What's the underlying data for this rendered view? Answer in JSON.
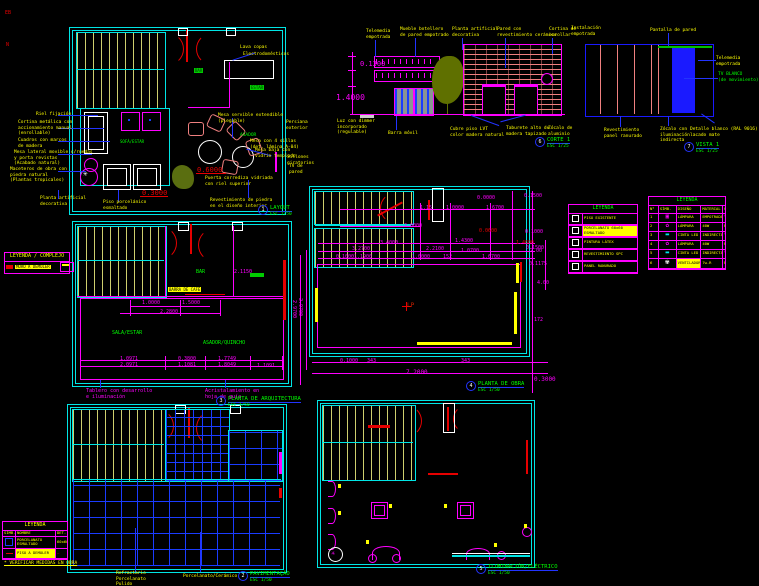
{
  "sheet": {
    "background": "#000000"
  },
  "palette": {
    "wall_cyan": "#00e5e5",
    "dim_magenta": "#ff00ff",
    "note_yellow": "#ffff00",
    "label_green": "#00ff00",
    "door_red": "#e60000",
    "leader_blue": "#2233ff",
    "furniture_salmon": "#f08080",
    "tile_blue": "#1a3cff",
    "tread_khaki": "#cfcf6e"
  },
  "titles": [
    {
      "num": "1",
      "name": "LAYOUT",
      "scale": "ESC 1/50"
    },
    {
      "num": "6",
      "name": "CORTE 1",
      "scale": "ESC 1/25"
    },
    {
      "num": "7",
      "name": "VISTA 1",
      "scale": "ESC 1/25"
    },
    {
      "num": "3",
      "name": "PLANTA DE ARQUITECTURA",
      "scale": "ESC 1/50"
    },
    {
      "num": "4",
      "name": "PLANTA DE OBRA",
      "scale": "ESC 1/50"
    },
    {
      "num": "2",
      "name": "PAVIMENTAÇÃO",
      "scale": "ESC 1/50"
    },
    {
      "num": "5",
      "name": "ILUMINACIÓN/ELÉCTRICO",
      "scale": "ESC 1/50"
    }
  ],
  "ann": {
    "misc": [
      {
        "t": "EB",
        "x": 5,
        "y": 10,
        "c": "#e60000",
        "fs": 5
      },
      {
        "t": "N",
        "x": 6,
        "y": 42,
        "c": "#e60000",
        "fs": 5
      }
    ],
    "layout": [
      {
        "t": "Riel fijación",
        "x": 36,
        "y": 112
      },
      {
        "t": "Cortina metálica con\naccionamiento manual\n(enrollable)",
        "x": 18,
        "y": 120
      },
      {
        "t": "Cuadros con marcos\nde madera",
        "x": 18,
        "y": 138
      },
      {
        "t": "Mesa lateral movible c/ruedas\ny porta revistas\n(Acabado natural)",
        "x": 14,
        "y": 150
      },
      {
        "t": "Maceteros de obra con\npiedra natural\n(Plantas tropicales)",
        "x": 10,
        "y": 167
      },
      {
        "t": "Planta artificial\ndecorativa",
        "x": 40,
        "y": 196
      },
      {
        "t": "Piso porcelánico\nesmaltado",
        "x": 103,
        "y": 200
      },
      {
        "t": "Lava copas",
        "x": 240,
        "y": 45
      },
      {
        "t": "Electrodomésticos",
        "x": 243,
        "y": 52
      },
      {
        "t": "Mesa servible extendible\n(plegable)",
        "x": 218,
        "y": 113
      },
      {
        "t": "Persiana\nexterior",
        "x": 286,
        "y": 120
      },
      {
        "t": "ASADOR",
        "x": 240,
        "y": 133,
        "c": "#00ff00"
      },
      {
        "t": "Mesa con 4 sillas\n(det. lámina A-04)",
        "x": 250,
        "y": 139
      },
      {
        "t": "Mesa baja con\nvidrio templado",
        "x": 255,
        "y": 148
      },
      {
        "t": "Sillones\ngiratorios",
        "x": 287,
        "y": 155
      },
      {
        "t": "TV de\npared",
        "x": 289,
        "y": 164
      },
      {
        "t": "0.6000",
        "x": 197,
        "y": 166,
        "c": "#e60000",
        "fs": 7
      },
      {
        "t": "0.3000",
        "x": 142,
        "y": 189,
        "c": "#e60000",
        "fs": 7
      },
      {
        "t": "Puerta corrediza vidriada\ncon riel superior",
        "x": 205,
        "y": 176
      },
      {
        "t": "Revestimiento de piedra\nen el diseño interior",
        "x": 210,
        "y": 198
      },
      {
        "t": "BAR",
        "x": 194,
        "y": 68,
        "bg": "#00cc00",
        "cc": "#003300",
        "fs": 4
      },
      {
        "t": "ESTAR",
        "x": 250,
        "y": 85,
        "bg": "#00cc00",
        "cc": "#003300",
        "fs": 4
      },
      {
        "t": "SOFÁ/ESTAR",
        "x": 120,
        "y": 139,
        "c": "#00ff00",
        "fs": 4
      }
    ],
    "corte": [
      {
        "t": "Telemedia\nempotrada",
        "x": 366,
        "y": 29
      },
      {
        "t": "Mueble botellero\nde pared empotrado",
        "x": 400,
        "y": 27
      },
      {
        "t": "Planta artificial\ndecorativa",
        "x": 452,
        "y": 27
      },
      {
        "t": "Pared con\nrevestimiento cerámico",
        "x": 497,
        "y": 27
      },
      {
        "t": "Cortina de\nenrollar",
        "x": 549,
        "y": 27
      },
      {
        "t": "0.1300",
        "x": 360,
        "y": 60,
        "c": "#ff00ff",
        "fs": 7
      },
      {
        "t": "1.4000",
        "x": 336,
        "y": 93,
        "c": "#ff00ff",
        "fs": 8
      },
      {
        "t": "Luz con dimmer\nincorporado\n(regulable)",
        "x": 337,
        "y": 119
      },
      {
        "t": "Barra móvil",
        "x": 388,
        "y": 131
      },
      {
        "t": "Cubre piso LVT\ncolor madera natural",
        "x": 450,
        "y": 127
      },
      {
        "t": "Taburete alto de\nmadera tapizado",
        "x": 506,
        "y": 126
      },
      {
        "t": "Zócalo de\naluminio",
        "x": 548,
        "y": 126
      }
    ],
    "vista": [
      {
        "t": "Instalación\nempotrada",
        "x": 571,
        "y": 26
      },
      {
        "t": "Pantalla de pared",
        "x": 650,
        "y": 28
      },
      {
        "t": "Telemedia\nempotrada",
        "x": 716,
        "y": 56
      },
      {
        "t": "TV BLANCO\n(de movimiento)",
        "x": 718,
        "y": 72,
        "c": "#00ff00"
      },
      {
        "t": "Revestimiento\npanel ranurado",
        "x": 604,
        "y": 128
      },
      {
        "t": "Zócalo con\niluminación\nindirecta",
        "x": 660,
        "y": 127
      },
      {
        "t": "Detalle blanco (RAL 9016)\nlacado mate",
        "x": 690,
        "y": 127
      }
    ],
    "arq": [
      {
        "t": "1.0000",
        "x": 142,
        "y": 300,
        "c": "#ff00ff"
      },
      {
        "t": "1.5000",
        "x": 182,
        "y": 300,
        "c": "#ff00ff"
      },
      {
        "t": "2.2800",
        "x": 160,
        "y": 309,
        "c": "#ff00ff"
      },
      {
        "t": "2.1150",
        "x": 234,
        "y": 269,
        "c": "#ff00ff"
      },
      {
        "t": "2.9700",
        "x": 297,
        "y": 300,
        "c": "#ff00ff",
        "r": 90
      },
      {
        "t": "1.0971",
        "x": 120,
        "y": 356,
        "c": "#ff00ff"
      },
      {
        "t": "2.0971",
        "x": 120,
        "y": 362,
        "c": "#ff00ff"
      },
      {
        "t": "0.3800",
        "x": 178,
        "y": 356,
        "c": "#ff00ff"
      },
      {
        "t": "1.1081",
        "x": 178,
        "y": 362,
        "c": "#ff00ff"
      },
      {
        "t": "1.7749",
        "x": 218,
        "y": 356,
        "c": "#ff00ff"
      },
      {
        "t": "1.8049",
        "x": 218,
        "y": 362,
        "c": "#ff00ff"
      },
      {
        "t": "1.1091",
        "x": 257,
        "y": 363,
        "c": "#ff00ff"
      },
      {
        "t": "BAR",
        "x": 196,
        "y": 269,
        "c": "#00ff00"
      },
      {
        "t": "SALA/ESTAR",
        "x": 112,
        "y": 330,
        "c": "#00ff00"
      },
      {
        "t": "ASADOR/QUINCHO",
        "x": 203,
        "y": 340,
        "c": "#00ff00"
      },
      {
        "t": "BARRA DE CAFÉ",
        "x": 168,
        "y": 287,
        "bg": "#ffff00",
        "fs": 4
      },
      {
        "t": "Tablero con desarrollo\ne iluminación",
        "x": 86,
        "y": 388
      },
      {
        "t": "Acristalamiento en\nhoja de guía",
        "x": 205,
        "y": 388
      }
    ],
    "obra": [
      {
        "t": "0.0000",
        "x": 477,
        "y": 195
      },
      {
        "t": "0.1500",
        "x": 524,
        "y": 193
      },
      {
        "t": "1.15",
        "x": 420,
        "y": 205
      },
      {
        "t": "1.0000",
        "x": 446,
        "y": 205
      },
      {
        "t": "1.6700",
        "x": 486,
        "y": 205
      },
      {
        "t": "2.0000",
        "x": 404,
        "y": 223
      },
      {
        "t": "0.0600",
        "x": 479,
        "y": 228,
        "c": "#e60000"
      },
      {
        "t": "0.1000",
        "x": 525,
        "y": 229
      },
      {
        "t": "3.4000",
        "x": 380,
        "y": 240
      },
      {
        "t": "1.4300",
        "x": 455,
        "y": 238
      },
      {
        "t": "1.4600",
        "x": 516,
        "y": 240,
        "c": "#e60000"
      },
      {
        "t": "0.1500",
        "x": 526,
        "y": 245
      },
      {
        "t": "3.2700",
        "x": 352,
        "y": 246
      },
      {
        "t": "2.2100",
        "x": 426,
        "y": 246
      },
      {
        "t": "1.0700",
        "x": 461,
        "y": 248
      },
      {
        "t": "2.00",
        "x": 530,
        "y": 248
      },
      {
        "t": "0.1000",
        "x": 336,
        "y": 254
      },
      {
        "t": "1.1900",
        "x": 354,
        "y": 254
      },
      {
        "t": "1.0000",
        "x": 412,
        "y": 254
      },
      {
        "t": "152",
        "x": 443,
        "y": 254
      },
      {
        "t": "1.6700",
        "x": 482,
        "y": 254
      },
      {
        "t": "0.1175",
        "x": 529,
        "y": 261
      },
      {
        "t": "4.00",
        "x": 537,
        "y": 280
      },
      {
        "t": "2.9700",
        "x": 303,
        "y": 298,
        "r": 90
      },
      {
        "t": "172",
        "x": 534,
        "y": 317
      },
      {
        "t": "LP",
        "x": 407,
        "y": 302,
        "c": "#cc2200",
        "fs": 6
      },
      {
        "t": "0.1000",
        "x": 340,
        "y": 358
      },
      {
        "t": "343",
        "x": 367,
        "y": 358
      },
      {
        "t": "343",
        "x": 461,
        "y": 358
      },
      {
        "t": "7.2000",
        "x": 406,
        "y": 369,
        "fs": 6
      },
      {
        "t": "0.3000",
        "x": 534,
        "y": 376,
        "fs": 6
      }
    ],
    "pav": [
      {
        "t": "Refractario\nPorcelanato\nPulido",
        "x": 116,
        "y": 571
      },
      {
        "t": "Porcelanato/Cerámico",
        "x": 183,
        "y": 574
      }
    ]
  },
  "legend_complejo": {
    "title": "LEYENDA / COMPLEJO",
    "row": "MURO A DEMOLER"
  },
  "legend_small": {
    "title": "LEYENDA",
    "rows": [
      "PISO EXISTENTE",
      "PORCELANATO 60x60 ESMALTADO",
      "PINTURA LÁTEX",
      "REVESTIMIENTO SPC",
      "PANEL RANURADO"
    ]
  },
  "legend_big": {
    "title": "LEYENDA",
    "headers": [
      "N°",
      "SÍMB.",
      "DISEÑO",
      "MATERIAL",
      "CANT."
    ],
    "rows": [
      {
        "n": "1",
        "sym": "▣",
        "syms": "color:#ff00ff",
        "c3": "LÁMPARA",
        "c4": "EMPOTRADA",
        "c5": "╲"
      },
      {
        "n": "2",
        "sym": "✿",
        "syms": "color:#ff00ff",
        "c3": "LÁMPARA",
        "c4": "40W",
        "c5": "Pz"
      },
      {
        "n": "3",
        "sym": "▬",
        "syms": "color:#00e5e5",
        "c3": "CINTA LED",
        "c4": "INDIRECTA",
        "c5": "╲"
      },
      {
        "n": "4",
        "sym": "✿",
        "syms": "color:#ff00ff",
        "c3": "LÁMPARA",
        "c4": "40W",
        "c5": "Pz"
      },
      {
        "n": "5",
        "sym": "▬",
        "syms": "color:#00e5e5",
        "c3": "CINTA LED",
        "c4": "INDIRECTA",
        "c5": "╲"
      },
      {
        "n": "6",
        "sym": "✾",
        "syms": "color:#ffffff",
        "c3": "VENTILADOR",
        "c4": "7w-R",
        "c5": "Pz"
      }
    ]
  },
  "legend_floor": {
    "title": "LEYENDA",
    "headers": [
      "SÍMB.",
      "NOMBRE",
      "DET."
    ],
    "r1_name": "PORCELANATO ESMALTADO",
    "r1_det": "60x60",
    "r2_name": "PISO A DEMOLER",
    "r2_det": "—",
    "note": "* VERIFICAR MEDIDAS EN OBRA"
  }
}
